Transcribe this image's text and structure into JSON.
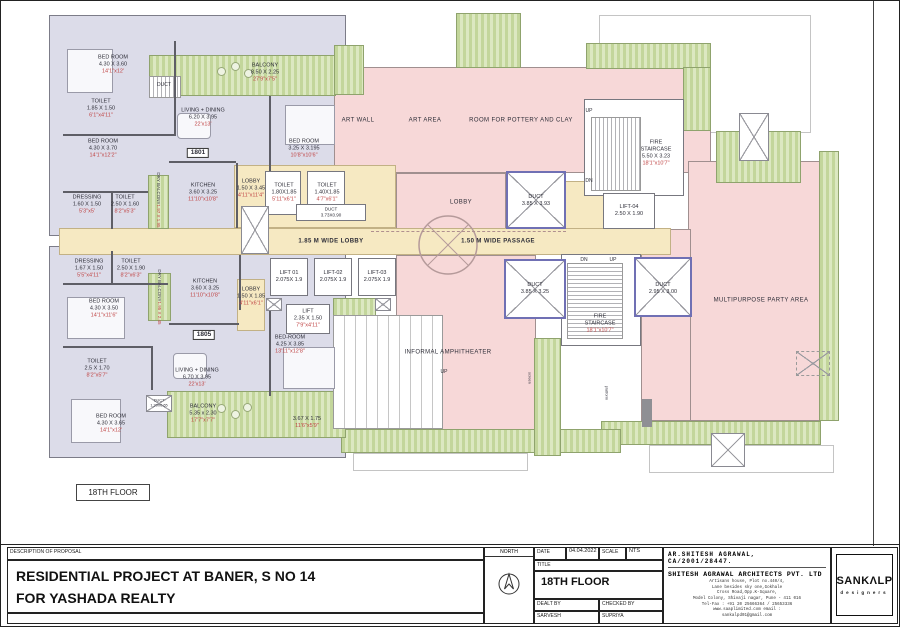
{
  "sheet": {
    "plan_floor_box": "18TH FLOOR",
    "description_header": "DESCRIPTION OF PROPOSAL",
    "description_line1": "RESIDENTIAL PROJECT AT BANER, S NO 14",
    "description_line2": "FOR YASHADA REALTY",
    "north_label": "NORTH",
    "fields": {
      "date_label": "DATE",
      "date_value": "04.04.2022",
      "scale_label": "SCALE",
      "scale_value": "NTS",
      "title_label": "TITLE",
      "title_value": "18TH FLOOR",
      "dealt_label": "DEALT BY",
      "dealt_value": "SARVESH",
      "checked_label": "CHECKED BY",
      "checked_value": "SUPRIYA"
    },
    "architect": {
      "line1": "AR.SHITESH AGRAWAL,",
      "line2": "CA/2001/28447.",
      "firm": "SHITESH AGRAWAL ARCHITECTS PVT. LTD",
      "address": [
        "Artisans house, Plot no.440/4,",
        "Lane besides sky one,Gokhale",
        "Cross Road,Opp.K-Square,",
        "Model Colony, Shivaji nagar, Pune - 411 016",
        "Tel-Fax : +91 20 25666364 / 25653336",
        "www.saaplimited.com          email :",
        "sankalpd01@gmail.com"
      ]
    },
    "logo": {
      "name": "SANKΛLP",
      "tagline": "designers"
    }
  },
  "rooms": {
    "bed1801a": {
      "n": "BED ROOM",
      "m": "4.30 X 3.60",
      "f": "14'1\"x12'"
    },
    "toil1801a": {
      "n": "TOILET",
      "m": "1.85 X 1.50",
      "f": "6'1\"x4'11\""
    },
    "bed1801b": {
      "n": "BED ROOM",
      "m": "4.30 X 3.70",
      "f": "14'1\"x12'2\""
    },
    "dress1801": {
      "n": "DRESSING",
      "m": "1.60 X 1.50",
      "f": "5'3\"x5'"
    },
    "toil1801b": {
      "n": "TOILET",
      "m": "2.50 X 1.60",
      "f": "8'2\"x5'3\""
    },
    "living1801": {
      "n": "LIVING + DINING",
      "m": "6.20 X 3.95",
      "f": "22'x13'"
    },
    "flat1801": {
      "n": "1801"
    },
    "kitchen1801": {
      "n": "KITCHEN",
      "m": "3.60 X 3.25",
      "f": "11'10\"x10'8\""
    },
    "dry1801": {
      "n": "DRY BALCONY",
      "m": "1.97 X 1.95"
    },
    "balc1801": {
      "n": "BALCONY",
      "m": "8.50 X 2.25",
      "f": "27'9\"x7'5\""
    },
    "ducttop": {
      "n": "DUCT"
    },
    "bedtr": {
      "n": "BED ROOM",
      "m": "3.25 X 3.195",
      "f": "10'8\"x10'6\""
    },
    "lobby1801": {
      "n": "LOBBY",
      "m": "1.50 X 3.45",
      "f": "4'11\"x11'4\""
    },
    "toiltrA": {
      "n": "TOILET",
      "m": "1.80X1.85",
      "f": "5'11\"x6'1\""
    },
    "toiltrB": {
      "n": "TOILET",
      "m": "1.40X1.85",
      "f": "4'7\"x6'1\""
    },
    "ductwide": {
      "n": "DUCT",
      "m": "3.73X0.90"
    },
    "artwall": {
      "n": "ART WALL"
    },
    "artarea": {
      "n": "ART AREA"
    },
    "pottery": {
      "n": "ROOM FOR POTTERY AND CLAY"
    },
    "lobbyam": {
      "n": "LOBBY"
    },
    "ductb1": {
      "n": "DUCT",
      "m": "3.85 X 3.93"
    },
    "firetop": {
      "n": "FIRE STAIRCASE",
      "m": "5.50 X 3.23",
      "f": "18'1\"x10'7\""
    },
    "lift04": {
      "n": "LIFT-04",
      "m": "2.50 X 1.90"
    },
    "corridor": {
      "n": "1.85 M WIDE LOBBY"
    },
    "passage": {
      "n": "1.50 M WIDE PASSAGE"
    },
    "lift01": {
      "n": "LIFT 01",
      "m": "2.075X 1.9"
    },
    "lift02": {
      "n": "LIFT-02",
      "m": "2.075X 1.9"
    },
    "lift03": {
      "n": "LIFT-03",
      "m": "2.075X 1.9"
    },
    "ductb2": {
      "n": "DUCT",
      "m": "3.85 X 3.25"
    },
    "ductb3": {
      "n": "DUCT",
      "m": "2.95 X 3.00"
    },
    "firebot": {
      "n": "FIRE STAIRCASE",
      "f": "18'1\"x10'7\""
    },
    "party": {
      "n": "MULTIPURPOSE PARTY AREA"
    },
    "amphi": {
      "n": "INFORMAL AMPHITHEATER"
    },
    "up": {
      "n": "UP"
    },
    "dn": {
      "n": "DN"
    },
    "screen": {
      "n": "screen"
    },
    "platform": {
      "n": "platform"
    },
    "dress1805": {
      "n": "DRESSING",
      "m": "1.67 X 1.50",
      "f": "5'5\"x4'11\""
    },
    "toil1805a": {
      "n": "TOILET",
      "m": "2.50 X 1.90",
      "f": "8'2\"x6'3\""
    },
    "bed1805a": {
      "n": "BED ROOM",
      "m": "4.30 X 3.50",
      "f": "14'1\"x11'6\""
    },
    "dry1805": {
      "n": "DRY BALCONY",
      "m": "1.95 X 2.45"
    },
    "kit1805": {
      "n": "KITCHEN",
      "m": "3.60 X 3.25",
      "f": "11'10\"x10'8\""
    },
    "lobby1805": {
      "n": "LOBBY",
      "m": "1.50 X 1.85",
      "f": "4'11\"x6'1\""
    },
    "toil1805b": {
      "n": "TOILET",
      "m": "2.5 X 1.70",
      "f": "8'2\"x5'7\""
    },
    "flat1805": {
      "n": "1805"
    },
    "living1805": {
      "n": "LIVING + DINING",
      "m": "6.70 X 3.95",
      "f": "22'x13'"
    },
    "bed1805b": {
      "n": "BED ROOM",
      "m": "4.30 X 3.65",
      "f": "14'1\"x12'"
    },
    "balc1805": {
      "n": "BALCONY",
      "m": "5.35 x 2.30",
      "f": "17'7\"x7'7\""
    },
    "duct1805": {
      "n": "DUCT",
      "m": "1.20X0.65"
    },
    "lift1805": {
      "n": "LIFT",
      "m": "2.35 X 1.50",
      "f": "7'9\"x4'11\""
    },
    "bed1805c": {
      "n": "BED-ROOM",
      "m": "4.25 X 3.85",
      "f": "13'11\"x12'8\""
    },
    "balcr": {
      "m": "3.67 X 1.75",
      "f": "11'6\"x5'9\""
    }
  }
}
